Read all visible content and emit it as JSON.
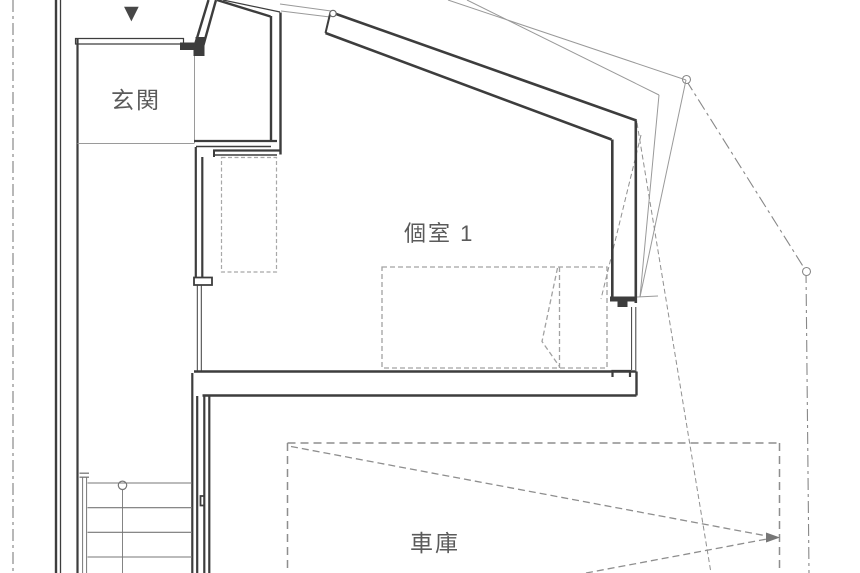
{
  "plan": {
    "type": "architectural-floor-plan",
    "floor_labels": {
      "entrance": "玄関",
      "room1": "個室 1",
      "garage": "車庫"
    },
    "icons": {
      "entrance_direction": "▼"
    },
    "colors": {
      "wall": "#3d3d3d",
      "thin_line": "#999999",
      "stair_line": "#777777",
      "dashed_furniture": "#a5a5a5",
      "dashed_garage": "#8e8e8e",
      "boundary": "#888888",
      "label_text": "#5a5a5a",
      "background": "#ffffff"
    }
  }
}
